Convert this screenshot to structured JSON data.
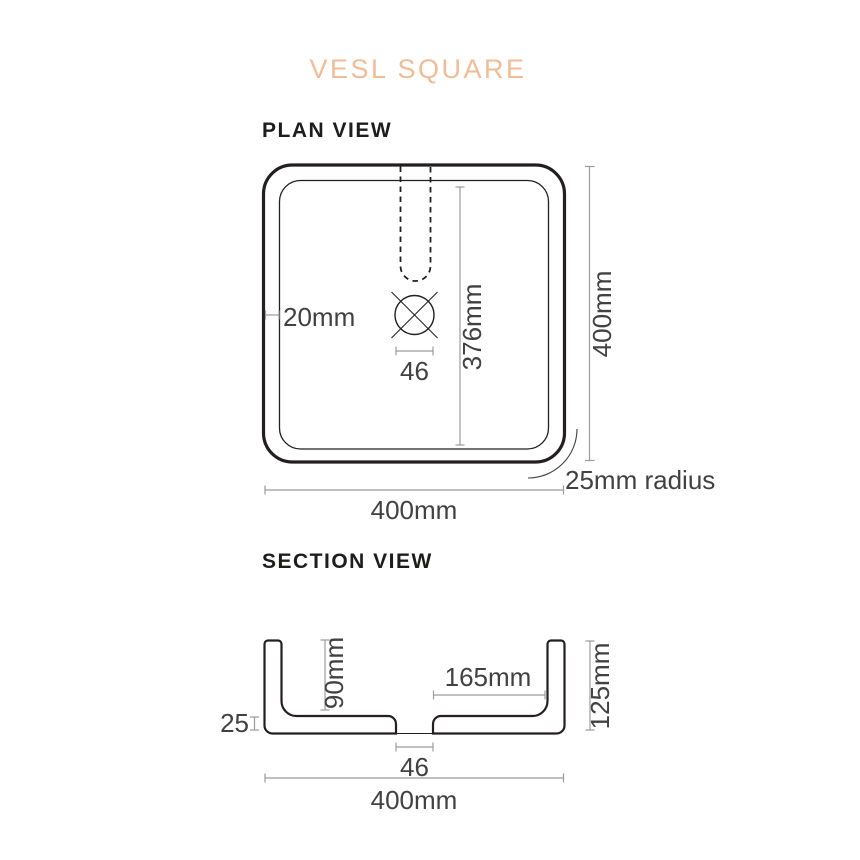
{
  "title": "VESL SQUARE",
  "colors": {
    "accent": "#f0bc98",
    "drawing_line": "#231f20",
    "dimension_line": "#9b9b9d",
    "dimension_text": "#414042",
    "heading_text": "#1d1d1b",
    "background": "#ffffff"
  },
  "plan_view": {
    "heading": "PLAN VIEW",
    "labels": {
      "wall_thickness": "20mm",
      "drain_width": "46",
      "basin_internal_length": "376mm",
      "overall_depth": "400mm",
      "corner_radius": "25mm radius",
      "overall_width": "400mm"
    }
  },
  "section_view": {
    "heading": "SECTION VIEW",
    "labels": {
      "internal_depth": "90mm",
      "drain_to_wall": "165mm",
      "overall_height": "125mm",
      "base_thickness": "25",
      "drain_width": "46",
      "overall_width": "400mm"
    }
  }
}
